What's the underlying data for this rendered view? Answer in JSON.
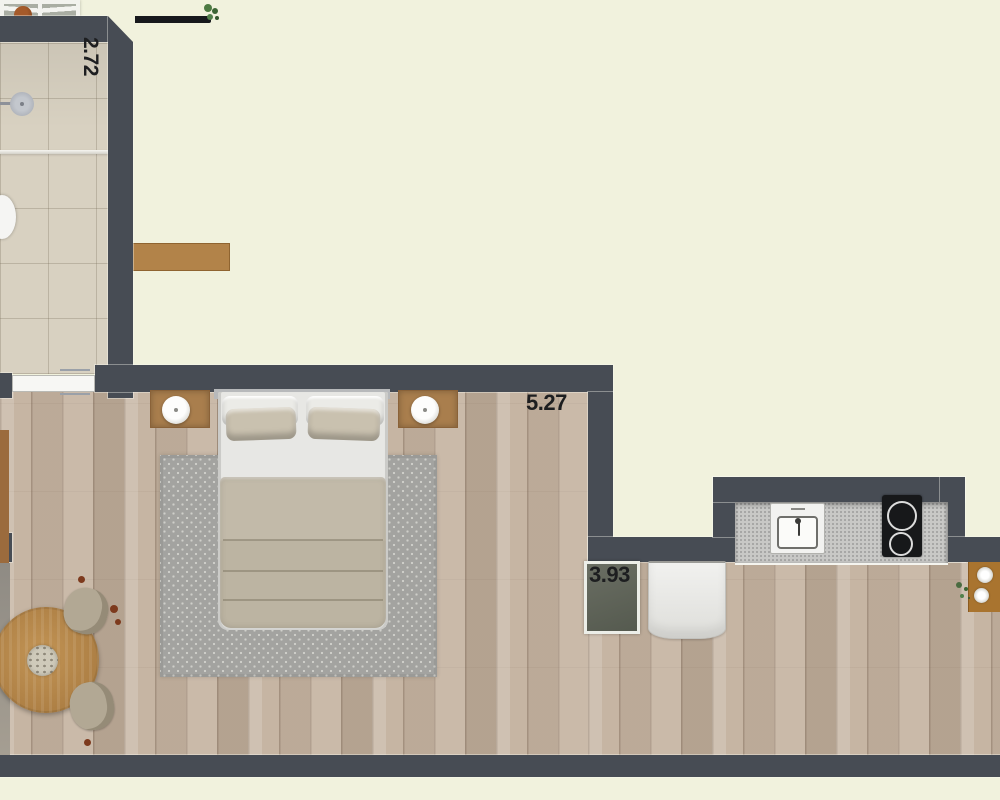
{
  "dimensions": {
    "bathroom": {
      "value": "2.72",
      "orientation": "vertical"
    },
    "wardrobe": {
      "value": "5.27",
      "orientation": "horizontal"
    },
    "kitchen": {
      "value": "3.93",
      "orientation": "horizontal"
    }
  },
  "colors": {
    "background": "#f1f2dd",
    "wall": "#474c54",
    "wood_floor": "#c6b5a3",
    "bathroom_tile": "#d8d1c1",
    "counter": "#c8c8c6",
    "rug": "#a3a3a0",
    "bedding": "#bcb4a2",
    "wood_furniture": "#a97e4d",
    "label_text": "#1d1e20"
  }
}
